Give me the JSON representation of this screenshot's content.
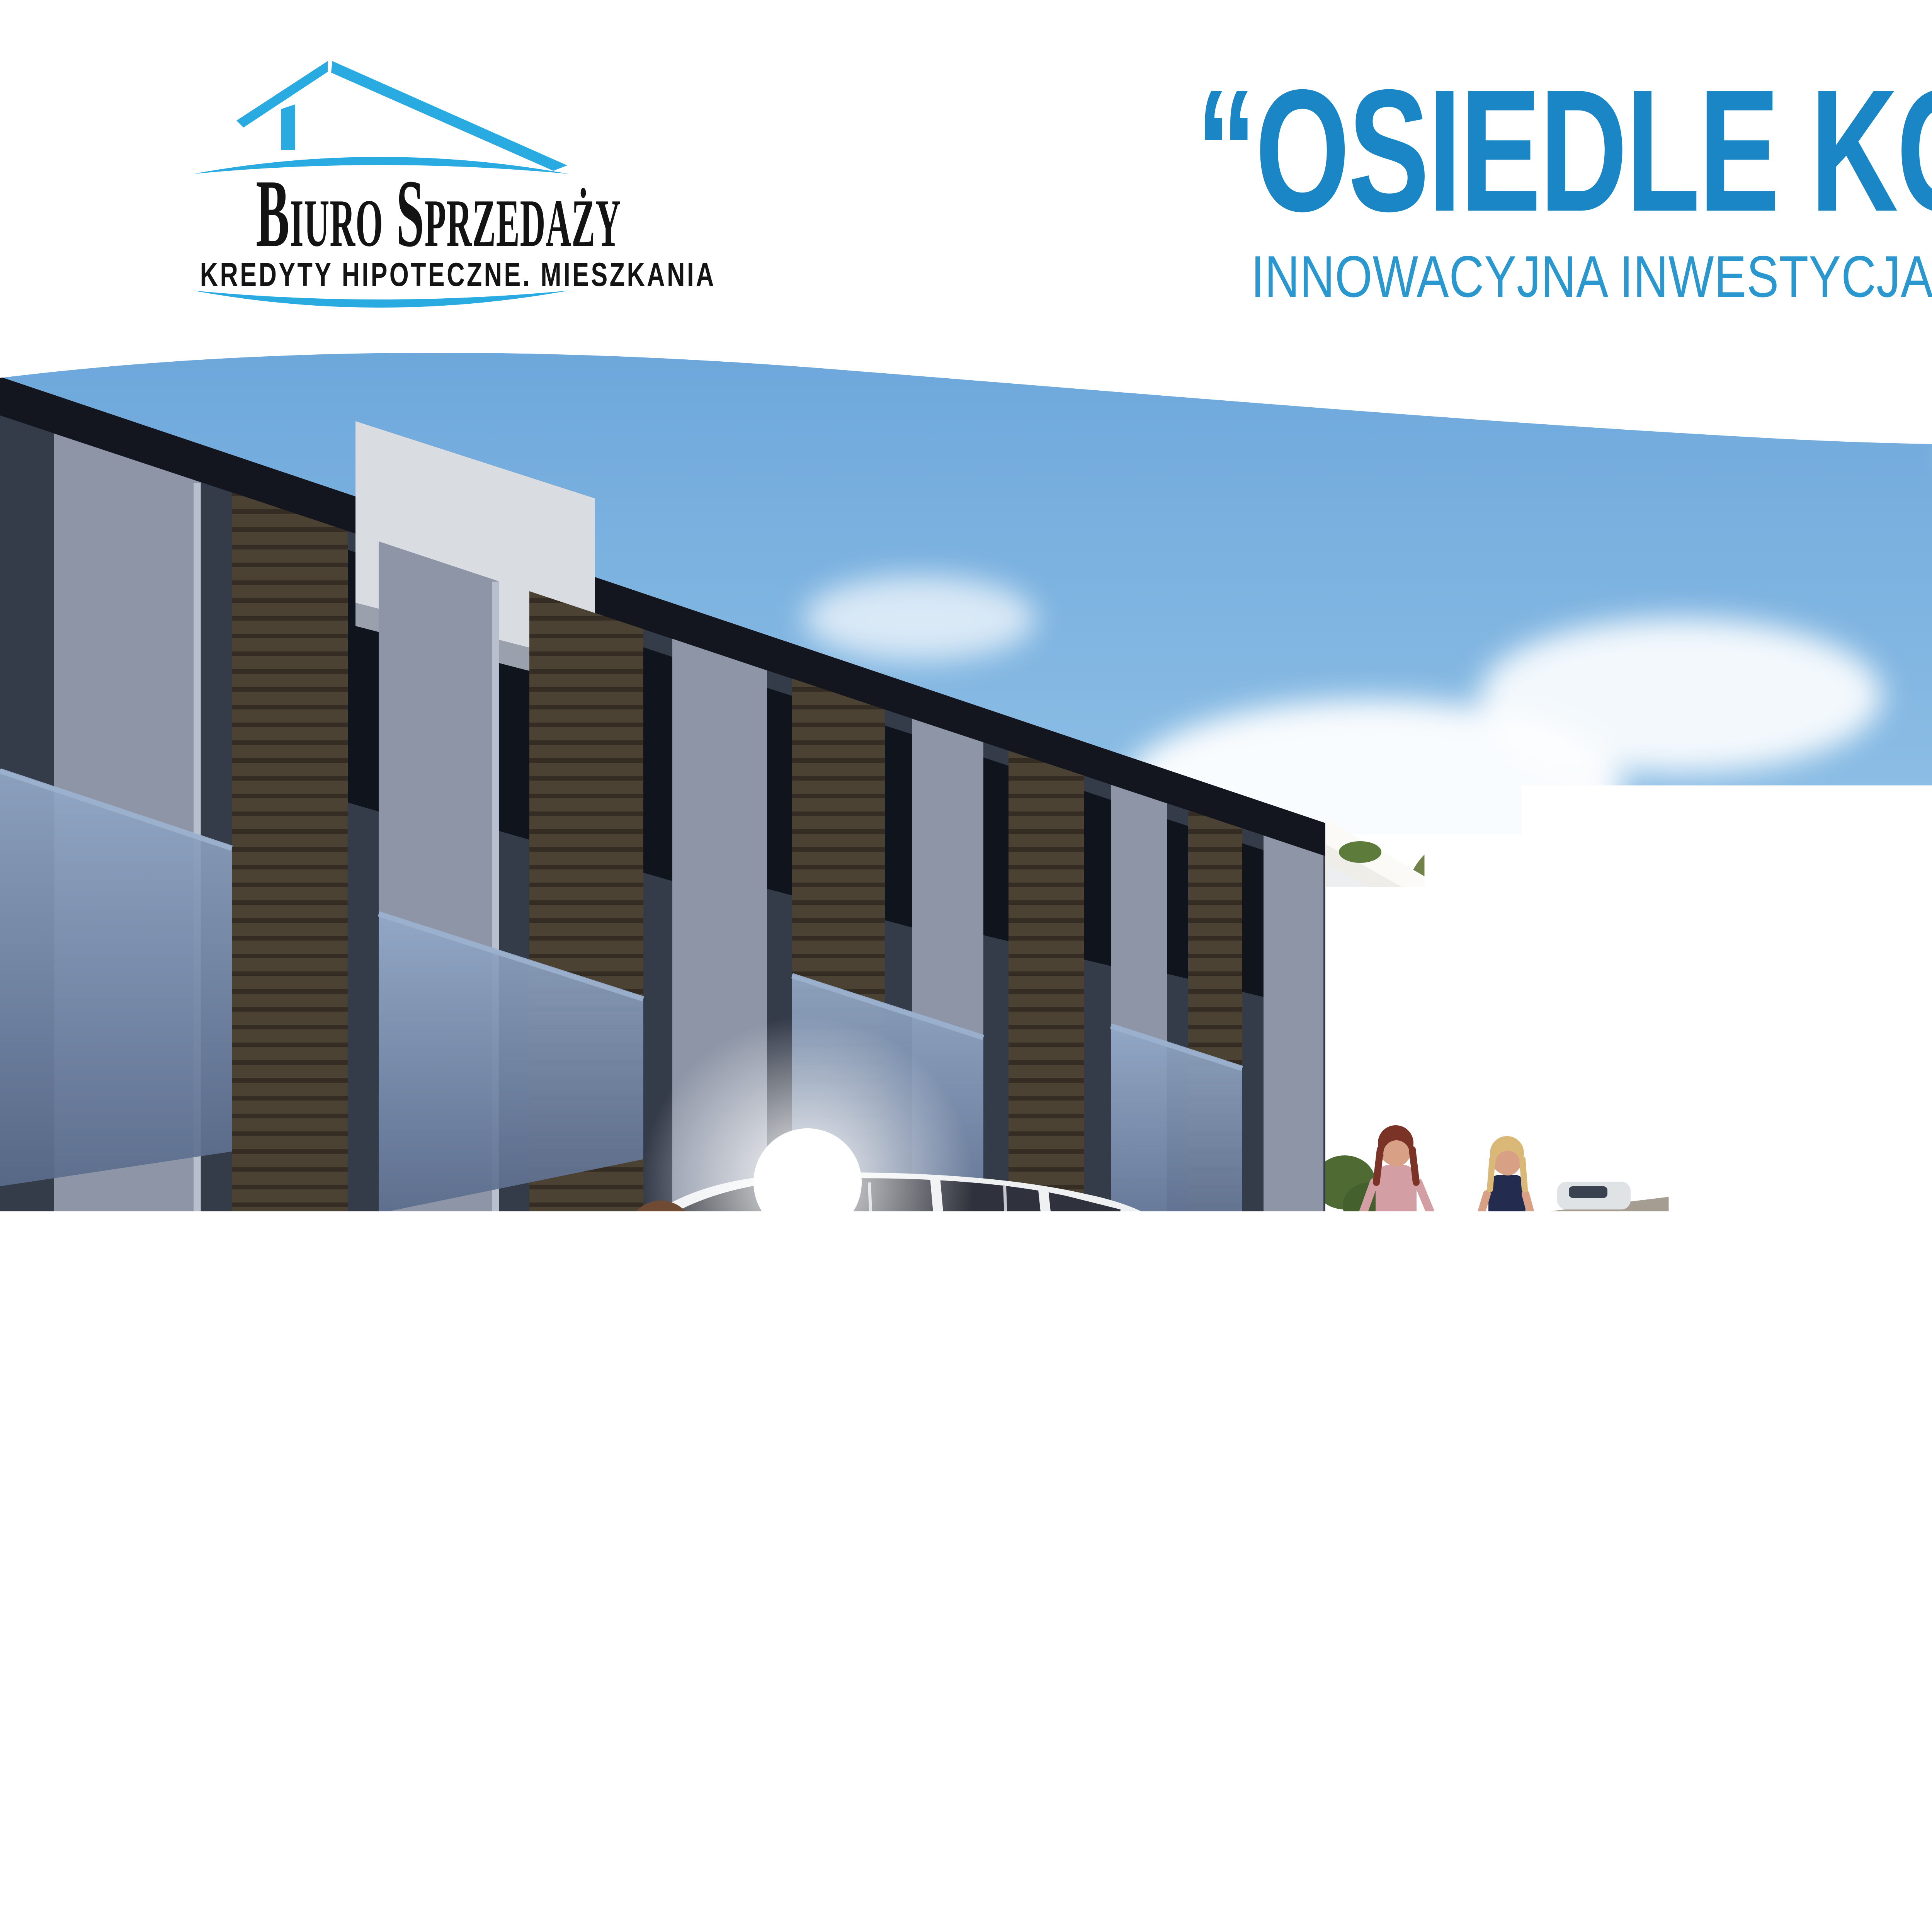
{
  "logo": {
    "name": "Biuro Sprzedaży",
    "tagline": "KREDYTY HIPOTECZNE. MIESZKANIA"
  },
  "header": {
    "title": "“OSIEDLE KORCZKA 32”",
    "subtitle": "INNOWACYJNA INWESTYCJA W RADZYMINIE"
  },
  "description": {
    "lines": [
      "Osiedle „Korczaka 32” to zorganizowany kompleks 40",
      "domów w zabudowie szeregowej. W skład inwestycji",
      "wchodzą domy 5 oraz 6 pokojowe. Do mniejszego",
      "metrażu są przewidziane parkingi, a do większego",
      "garaże.",
      "Bez względu na to, który z naszych budynków wybie-",
      "rzesz, będziesz mógł cieszyć się wysokim komfor-",
      "tem życia. Gwarantują to nowoczesne technologie,",
      "przemyślany układ pomieszczeń oraz oryginalna",
      "architektura. Te cechy sprawiają, że nowe mieszkania",
      "wyróżniają się na tle konkurencyjnych ofert."
    ]
  },
  "footer": {
    "phone": "tel. 604 771 746",
    "website": "www.biurosprzedazy.com.pl",
    "www_label": "www"
  },
  "icons": {
    "logo_icon": "house-roof-icon",
    "phone_icon": "phone-icon",
    "website_icon": "globe-www-icon"
  },
  "colors": {
    "logo_blue": "#29abe2",
    "title_blue": "#1b86c5",
    "subtitle_blue": "#2b97cf",
    "text_black": "#141414",
    "sky_top": "#6aa5da",
    "sky_bottom": "#c2ddf1"
  }
}
